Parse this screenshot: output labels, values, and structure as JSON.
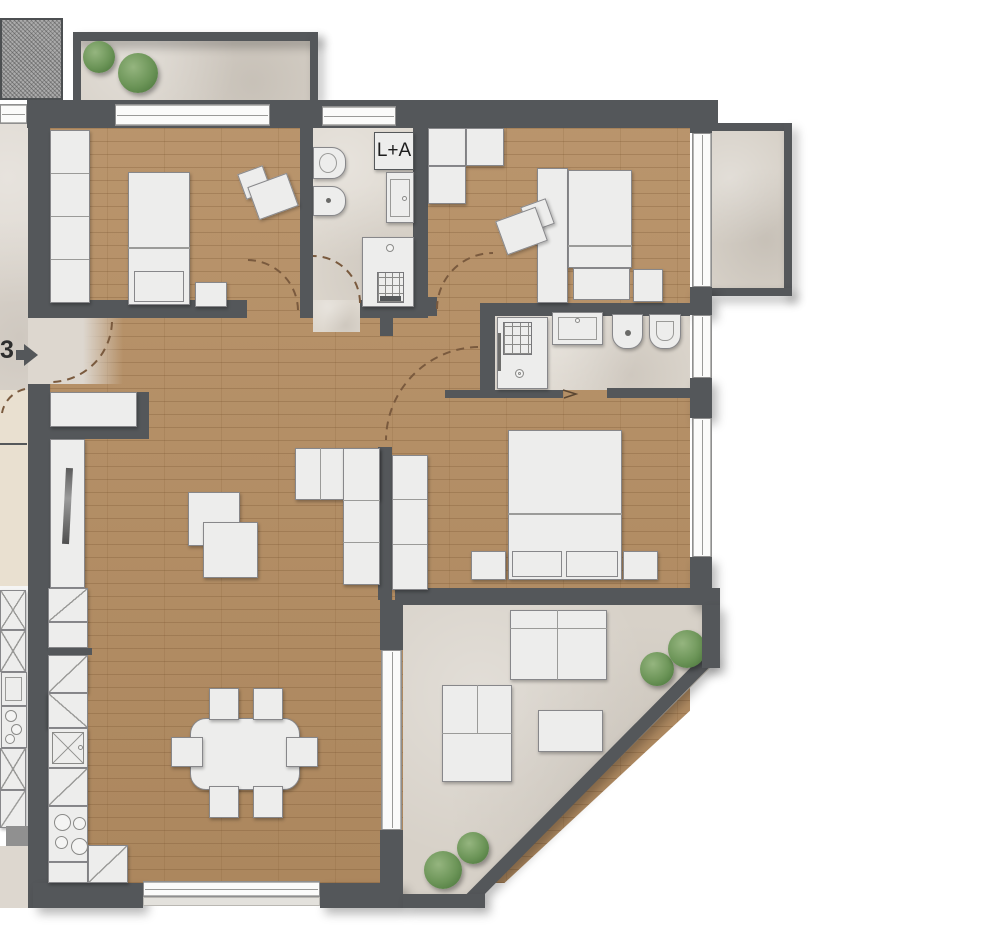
{
  "plan": {
    "unit_number": "3",
    "laundry_room_label": "L+A"
  },
  "colors": {
    "wall": "#54575a",
    "wood": "#b58e63",
    "tile": "#ddd7ce",
    "terrace": "#d7d1c8",
    "corridor": "#ddd7cf",
    "neighbor_wood": "#e9e0d0",
    "furniture": "#ededec",
    "furniture_border": "#87878a",
    "plant": "#6b9457",
    "arc": "#7a5a3e",
    "gravel": "#ababab",
    "window": "#fbfbfa",
    "sill": "#e3e1dc"
  }
}
